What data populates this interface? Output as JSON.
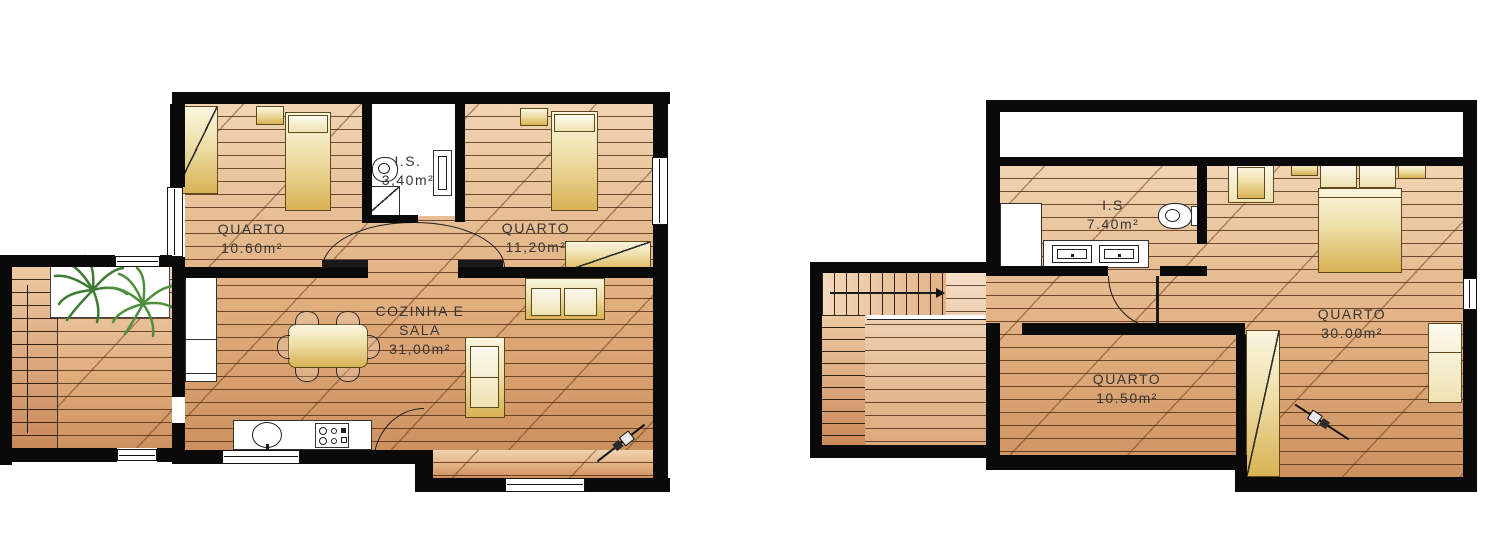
{
  "title": "Planta de habitação - dois pisos",
  "plans": {
    "left": {
      "rooms": [
        {
          "name": "QUARTO",
          "area": "10.60m²"
        },
        {
          "name": "I.S.",
          "area": "3,40m²"
        },
        {
          "name": "QUARTO",
          "area": "11,20m²"
        },
        {
          "name_line1": "COZINHA E",
          "name_line2": "SALA",
          "area": "31,00m²"
        }
      ]
    },
    "right": {
      "rooms": [
        {
          "name": "I.S",
          "area": "7.40m²"
        },
        {
          "name": "QUARTO",
          "area": "30.00m²"
        },
        {
          "name": "QUARTO",
          "area": "10.50m²"
        }
      ]
    }
  },
  "colors": {
    "wall": "#0a0a0a",
    "floor_light": "#f0d4b2",
    "floor_dark": "#cd9160",
    "furniture_gold": "#d9b254",
    "plant_green": "#3e7c35",
    "label_text": "#363636"
  }
}
